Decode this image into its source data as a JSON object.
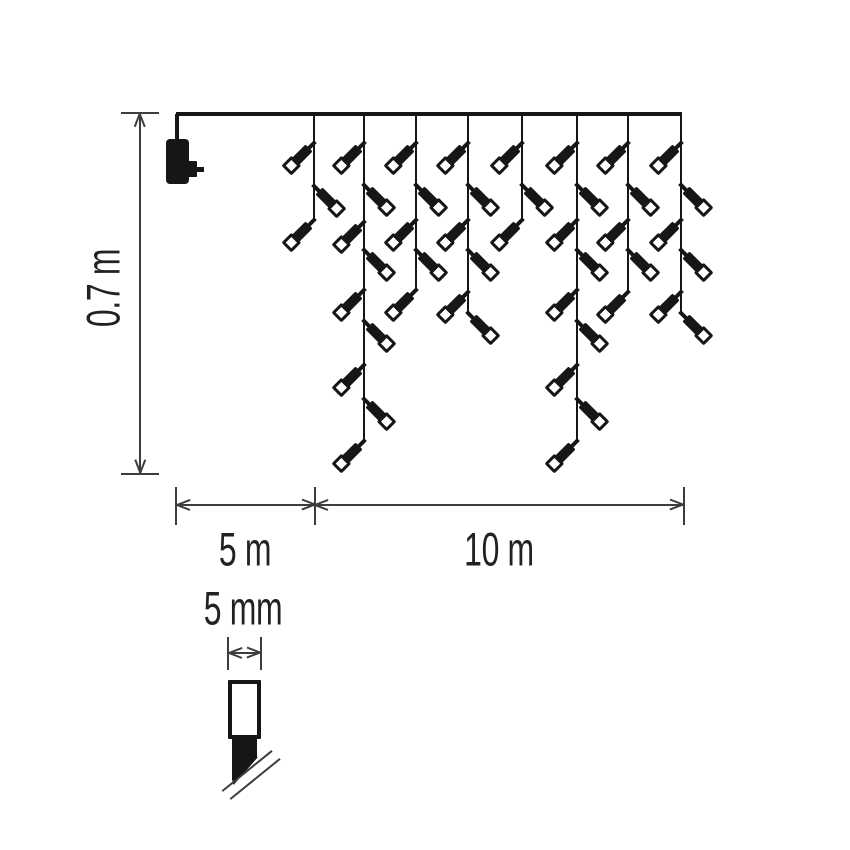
{
  "labels": {
    "height": "0.7 m",
    "lead_length": "5 m",
    "lit_length": "10 m",
    "bulb_width": "5 mm"
  },
  "colors": {
    "ink": "#161616",
    "line": "#3d3d3d",
    "text": "#222222",
    "background": "#ffffff"
  },
  "figure": {
    "wire": {
      "x1": 176,
      "x2": 681,
      "y": 114
    },
    "adapter": {
      "cord_x": 177,
      "x": 166,
      "y": 139,
      "w": 23,
      "h": 45,
      "pin_x": 188,
      "pin_y": 161,
      "pin_w": 9,
      "pin_h": 16,
      "prong_x": 196,
      "prong_y": 167,
      "prong_w": 8,
      "prong_h": 5
    },
    "drops": [
      {
        "x": 314,
        "end": 220,
        "bulbs": [
          [
            143,
            "L"
          ],
          [
            186,
            "R"
          ],
          [
            220,
            "L"
          ]
        ]
      },
      {
        "x": 364,
        "end": 441,
        "bulbs": [
          [
            143,
            "L"
          ],
          [
            185,
            "R"
          ],
          [
            222,
            "L"
          ],
          [
            250,
            "R"
          ],
          [
            290,
            "L"
          ],
          [
            321,
            "R"
          ],
          [
            365,
            "L"
          ],
          [
            399,
            "R"
          ],
          [
            441,
            "L"
          ]
        ]
      },
      {
        "x": 416,
        "end": 290,
        "bulbs": [
          [
            143,
            "L"
          ],
          [
            185,
            "R"
          ],
          [
            220,
            "L"
          ],
          [
            250,
            "R"
          ],
          [
            290,
            "L"
          ]
        ]
      },
      {
        "x": 468,
        "end": 313,
        "bulbs": [
          [
            143,
            "L"
          ],
          [
            185,
            "R"
          ],
          [
            220,
            "L"
          ],
          [
            250,
            "R"
          ],
          [
            292,
            "L"
          ],
          [
            313,
            "R"
          ]
        ]
      },
      {
        "x": 522,
        "end": 220,
        "bulbs": [
          [
            143,
            "L"
          ],
          [
            185,
            "R"
          ],
          [
            220,
            "L"
          ]
        ]
      },
      {
        "x": 577,
        "end": 441,
        "bulbs": [
          [
            143,
            "L"
          ],
          [
            185,
            "R"
          ],
          [
            220,
            "L"
          ],
          [
            250,
            "R"
          ],
          [
            290,
            "L"
          ],
          [
            321,
            "R"
          ],
          [
            365,
            "L"
          ],
          [
            399,
            "R"
          ],
          [
            441,
            "L"
          ]
        ]
      },
      {
        "x": 628,
        "end": 292,
        "bulbs": [
          [
            143,
            "L"
          ],
          [
            185,
            "R"
          ],
          [
            220,
            "L"
          ],
          [
            250,
            "R"
          ],
          [
            292,
            "L"
          ]
        ]
      },
      {
        "x": 681,
        "end": 313,
        "bulbs": [
          [
            143,
            "L"
          ],
          [
            185,
            "R"
          ],
          [
            220,
            "L"
          ],
          [
            250,
            "R"
          ],
          [
            292,
            "L"
          ],
          [
            313,
            "R"
          ]
        ]
      }
    ]
  },
  "dimensions": {
    "height": {
      "x": 140,
      "y_top": 113,
      "y_bottom": 474,
      "tick_x1": 121,
      "tick_x2": 159,
      "label_cx": 103,
      "label_cy": 288
    },
    "span": {
      "y": 505,
      "x_start": 176,
      "x_mid": 315,
      "x_end": 684,
      "tick_y1": 487,
      "tick_y2": 525,
      "lead_cx": 245,
      "lit_cx": 499,
      "label_cy": 549
    },
    "bulb": {
      "y": 653,
      "x1": 228,
      "x2": 261,
      "tick_y1": 637,
      "tick_y2": 670,
      "label_cx": 243,
      "label_cy": 608
    }
  },
  "detail": {
    "lens": {
      "x": 228,
      "y": 680,
      "w": 33,
      "h": 59
    },
    "base": {
      "x": 232,
      "y": 738,
      "w": 25,
      "h": 20
    },
    "tip": {
      "x": 232,
      "y": 757,
      "w": 26,
      "h": 28
    },
    "break_lines": [
      {
        "cx": 247,
        "cy": 771
      },
      {
        "cx": 255,
        "cy": 779
      }
    ],
    "break_angle": -39,
    "break_len": 64
  }
}
